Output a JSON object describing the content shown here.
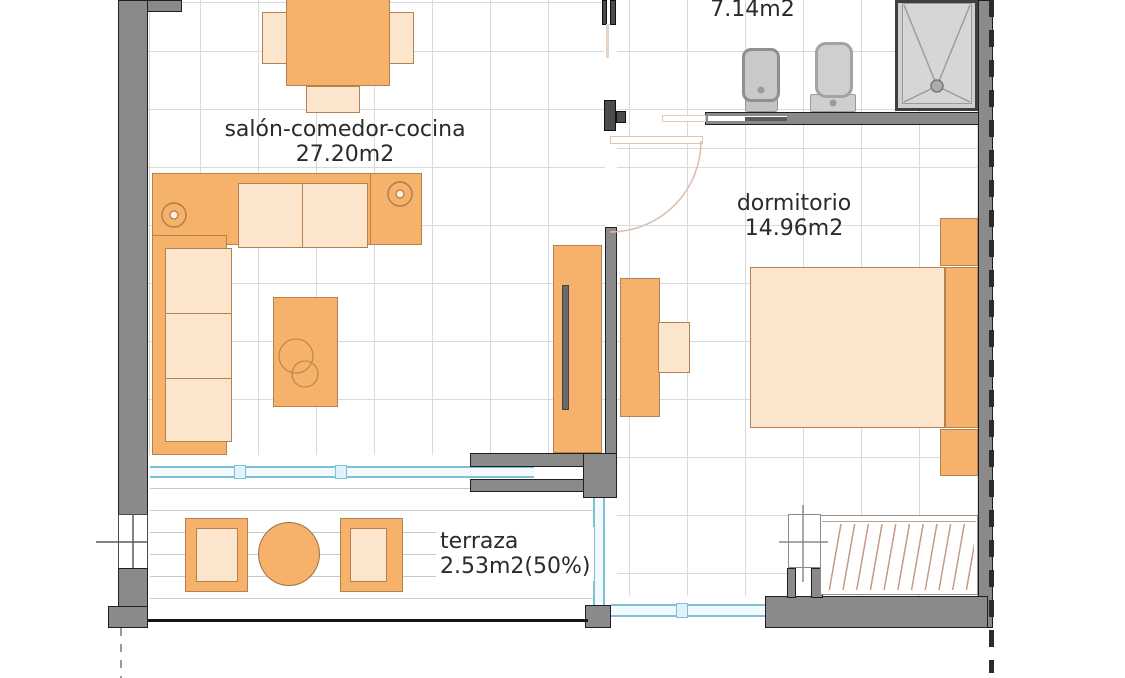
{
  "floorplan": {
    "title": "apartment floor plan",
    "rooms": [
      {
        "id": "living",
        "label": "salón-comedor-cocina",
        "area": "27.20m2"
      },
      {
        "id": "bathroom",
        "label": "",
        "area": "7.14m2"
      },
      {
        "id": "bedroom",
        "label": "dormitorio",
        "area": "14.96m2"
      },
      {
        "id": "terrace",
        "label": "terraza",
        "area": "2.53m2(50%)"
      }
    ],
    "colors": {
      "wall_gray": "#8a8a8a",
      "wall_outline": "#1f1f1f",
      "furniture_orange": "#f6b26b",
      "furniture_light": "#fbe5cd",
      "furniture_border": "#b5814e",
      "grid_line": "#dadada",
      "glazing_blue": "#7fc0d8",
      "fixture_gray": "#c9c9c9",
      "hatch_brown": "#c79b8b",
      "door_swing": "#d9c0b0",
      "boundary_dash": "#2b2b2b",
      "text": "#2a2a2a"
    }
  }
}
